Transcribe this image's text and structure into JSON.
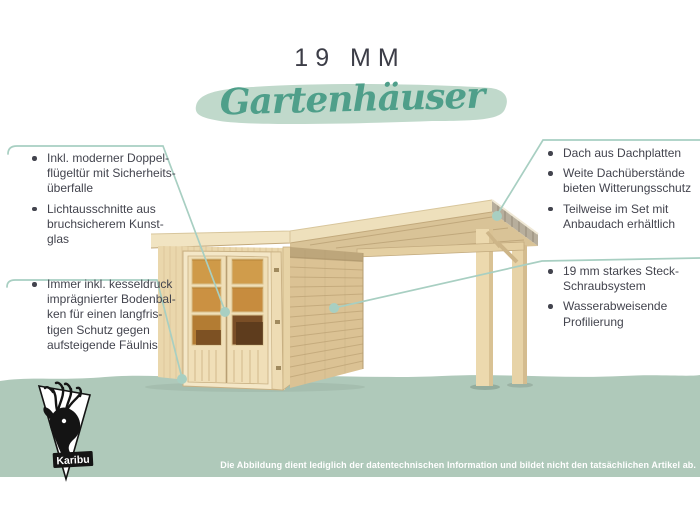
{
  "header": {
    "size_label": "19 MM",
    "title": "Gartenhäuser"
  },
  "left_panel": {
    "blocks": [
      {
        "items": [
          {
            "lines": [
              "Inkl. moderner Doppel-",
              "flügeltür mit Sicherheits-",
              "überfalle"
            ]
          },
          {
            "lines": [
              "Lichtausschnitte aus",
              "bruchsicherem Kunst-",
              "glas"
            ]
          }
        ]
      },
      {
        "items": [
          {
            "lines": [
              "Immer inkl. kesseldruck",
              "imprägnierter Bodenbal-",
              "ken für einen langfris-",
              "tigen Schutz gegen",
              "aufsteigende Fäulnis"
            ]
          }
        ]
      }
    ]
  },
  "right_panel": {
    "blocks": [
      {
        "items": [
          {
            "lines": [
              "Dach aus Dachplatten"
            ]
          },
          {
            "lines": [
              "Weite Dachüberstände",
              "bieten Witterungsschutz"
            ]
          },
          {
            "lines": [
              "Teilweise im Set mit",
              "Anbaudach erhältlich"
            ]
          }
        ]
      },
      {
        "items": [
          {
            "lines": [
              "19 mm starkes Steck-",
              "Schraubsystem"
            ]
          },
          {
            "lines": [
              "Wasserabweisende",
              "Profilierung"
            ]
          }
        ]
      }
    ]
  },
  "footer": {
    "disclaimer": "Die Abbildung dient lediglich der datentechnischen Information und bildet nicht den tatsächlichen Artikel ab."
  },
  "logo": {
    "brand": "Karibu"
  },
  "colors": {
    "accent_teal": "#4f9f8a",
    "brush_stroke": "#c0d9cb",
    "ground_band": "#afc9ba",
    "callout_line": "#a8cfc2",
    "body_text": "#43444e",
    "wood_light": "#f1e4c2",
    "wood_mid": "#ead7ac",
    "wood_dark": "#dbc294",
    "window_amber": "#cb9142",
    "roof_edge_grey": "#b7ae9c"
  }
}
